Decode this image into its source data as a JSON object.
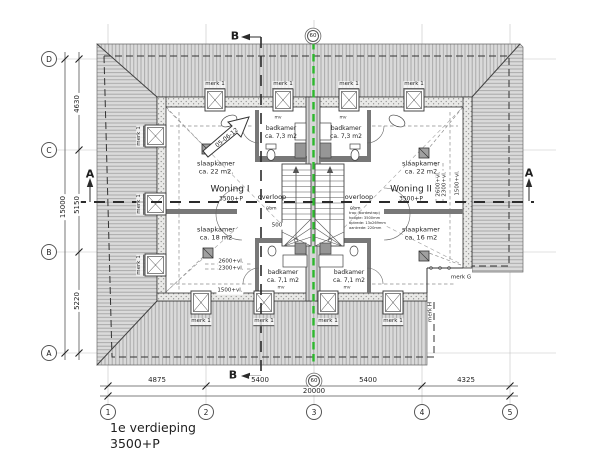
{
  "drawing": {
    "title_line1": "1e verdieping",
    "title_line2": "3500+P"
  },
  "grid": {
    "rows": [
      "D",
      "C",
      "B",
      "A"
    ],
    "cols": [
      "1",
      "2",
      "3",
      "4",
      "5"
    ],
    "axis60": "60"
  },
  "dims": {
    "left": [
      "4630",
      "5150",
      "5220"
    ],
    "left_total": "15000",
    "bottom": [
      "4875",
      "5400",
      "5400",
      "4325"
    ],
    "bottom_total": "20000"
  },
  "sections": {
    "a": "A",
    "b": "B"
  },
  "units": [
    {
      "name": "Woning I",
      "level": "3500+P",
      "landing": "overloop",
      "bedroom_large": "slaapkamer",
      "bedroom_large_area": "ca. 22 m2.",
      "bedroom_small": "slaapkamer",
      "bedroom_small_area": "ca. 18 m2",
      "bathroom_top": "badkamer",
      "bathroom_top_area": "ca. 7,3 m2",
      "bathroom_bottom": "badkamer",
      "bathroom_bottom_area": "ca. 7,1 m2"
    },
    {
      "name": "Woning II",
      "level": "3500+P",
      "landing": "overloop",
      "bedroom_large": "slaapkamer",
      "bedroom_large_area": "ca. 22 m2",
      "bedroom_small": "slaapkamer",
      "bedroom_small_area": "ca. 16 m2",
      "bathroom_top": "badkamer",
      "bathroom_top_area": "ca. 7,3 m2",
      "bathroom_bottom": "badkamer",
      "bathroom_bottom_area": "ca. 7,1 m2"
    }
  ],
  "marks": {
    "merk1": "merk 1",
    "merkG": "merk G",
    "merkH": "merk H"
  },
  "annotations": {
    "mv": "mv",
    "bm": "bm",
    "bm_icon": "⊖",
    "dim500": "500",
    "revision": "05-06-12",
    "h2600": "2600+vl.",
    "h2300": "2300+vl.",
    "h1500": "1500+vl.",
    "stair_note": [
      "trap (bordestrap)",
      "hoogte: 3500mm",
      "optrede: 13x269mm",
      "aantrede: 220mm"
    ]
  },
  "colors": {
    "party_wall_line": "#2db82d"
  }
}
